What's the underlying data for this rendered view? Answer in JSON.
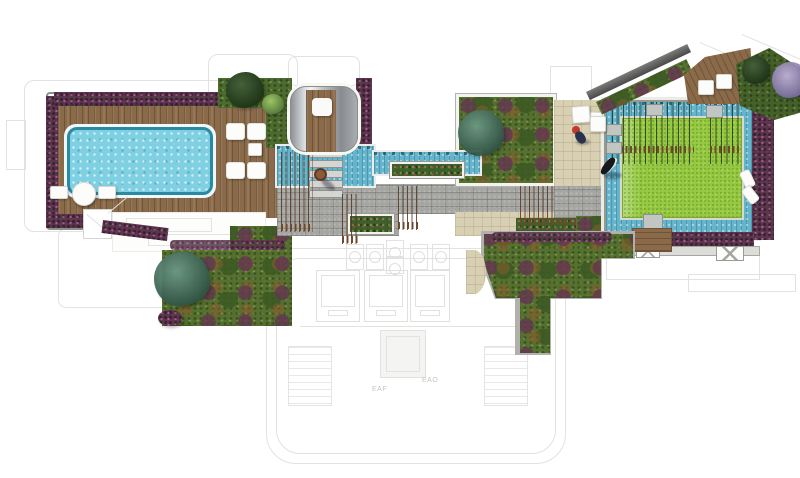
{
  "drawing": {
    "title": "Rooftop amenity landscape plan",
    "type": "top-view architectural landscape plan",
    "underlay": {
      "label_eaf": "EAF",
      "label_eao": "EAO"
    },
    "colors": {
      "pool_water": "#7fd0e2",
      "pool_edge": "#2b8aa0",
      "channel_water": "#64b5cc",
      "deck_wood": "#8a6a49",
      "lawn_green": "#96ca40",
      "planting_green": "#4e6b2f",
      "planting_purple": "#5d3550",
      "paving_gray": "#a5a5a1",
      "paving_beige": "#d9cfb2",
      "wall_gray": "#9a9a96",
      "underlay_line": "#e2e2e0",
      "furniture_white": "#fcfcfb"
    },
    "features": {
      "pool_terrace": "swimming pool on timber deck with sun loungers and round table",
      "bar_counter": "outdoor counter area",
      "planting_beds": "mixed shrub and flower planting beds",
      "water_feature": "reflecting channel with stepping stones and hedge planter",
      "spa_pavilion": "metal-framed timber spa pavilion",
      "central_garden": "central garden bed with specimen tree",
      "stone_walk": "flagstone walkway with rows of climbing vines",
      "event_lawn": "lawn island surrounded by water moat with bamboo rows",
      "timber_deck_ne": "angled timber deck with seat pads",
      "figures": "three human figures",
      "underlay_plan": "greyline floor plan with exhaust fans, lifts and stairs"
    }
  }
}
